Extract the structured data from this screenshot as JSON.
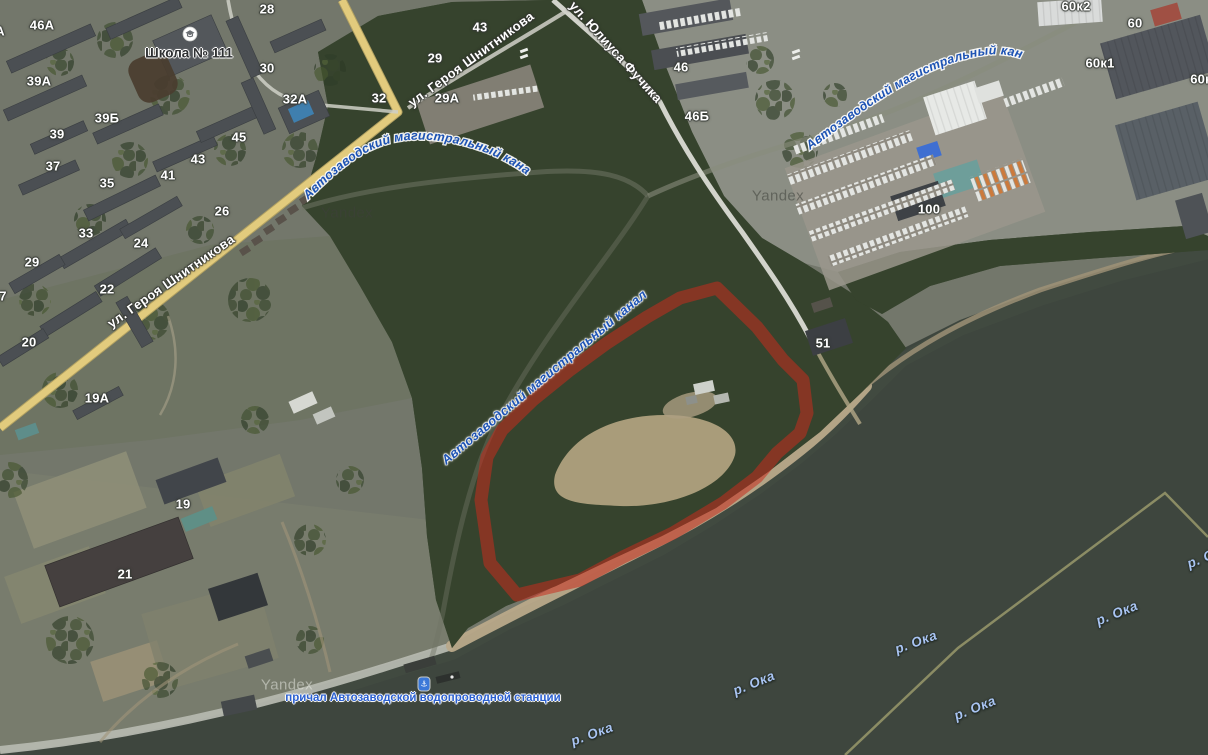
{
  "map": {
    "provider_watermark": "Yandex",
    "canal_label": "Автозаводский магистральный канал",
    "river_label": "р. Ока",
    "poi": {
      "school": {
        "label": "Школа № 111",
        "icon": "school-icon"
      },
      "pier": {
        "label": "причал Автозаводской водопроводной станции",
        "icon": "anchor-icon"
      }
    },
    "street_labels": [
      {
        "text": "ул. Героя Шнитникова",
        "x": 171,
        "y": 281,
        "rotate": -35
      },
      {
        "text": "ул. Героя Шнитникова",
        "x": 471,
        "y": 59,
        "rotate": -36
      },
      {
        "text": "ул. Юлиуса Фучика",
        "x": 616,
        "y": 52,
        "rotate": 48
      }
    ],
    "canal_label_placements": [
      {
        "placement": "forest-diagonal",
        "x": 544,
        "y": 377,
        "rotate": -40
      },
      {
        "placement": "curved-top-center"
      },
      {
        "placement": "curved-top-right"
      }
    ],
    "river_labels": [
      {
        "x": 592,
        "y": 734,
        "rotate": -20
      },
      {
        "x": 754,
        "y": 683,
        "rotate": -22
      },
      {
        "x": 916,
        "y": 642,
        "rotate": -20
      },
      {
        "x": 975,
        "y": 708,
        "rotate": -22
      },
      {
        "x": 1117,
        "y": 613,
        "rotate": -22
      },
      {
        "x": 1208,
        "y": 556,
        "rotate": -22
      }
    ],
    "house_numbers": [
      {
        "text": "А",
        "x": 0,
        "y": 31
      },
      {
        "text": "46А",
        "x": 42,
        "y": 25
      },
      {
        "text": "28",
        "x": 267,
        "y": 9
      },
      {
        "text": "30",
        "x": 267,
        "y": 68
      },
      {
        "text": "39А",
        "x": 39,
        "y": 81
      },
      {
        "text": "32А",
        "x": 295,
        "y": 99
      },
      {
        "text": "32",
        "x": 379,
        "y": 98
      },
      {
        "text": "39Б",
        "x": 107,
        "y": 118
      },
      {
        "text": "39",
        "x": 57,
        "y": 134
      },
      {
        "text": "45",
        "x": 239,
        "y": 137
      },
      {
        "text": "43",
        "x": 198,
        "y": 159
      },
      {
        "text": "37",
        "x": 53,
        "y": 166
      },
      {
        "text": "41",
        "x": 168,
        "y": 175
      },
      {
        "text": "35",
        "x": 107,
        "y": 183
      },
      {
        "text": "33",
        "x": 86,
        "y": 233
      },
      {
        "text": "26",
        "x": 222,
        "y": 211
      },
      {
        "text": "24",
        "x": 141,
        "y": 243
      },
      {
        "text": "29",
        "x": 32,
        "y": 262
      },
      {
        "text": "22",
        "x": 107,
        "y": 289
      },
      {
        "text": "7",
        "x": 3,
        "y": 296
      },
      {
        "text": "20",
        "x": 29,
        "y": 342
      },
      {
        "text": "19А",
        "x": 97,
        "y": 398
      },
      {
        "text": "19",
        "x": 183,
        "y": 504
      },
      {
        "text": "21",
        "x": 125,
        "y": 574
      },
      {
        "text": "29",
        "x": 435,
        "y": 58
      },
      {
        "text": "29А",
        "x": 447,
        "y": 98
      },
      {
        "text": "43",
        "x": 480,
        "y": 27
      },
      {
        "text": "46",
        "x": 681,
        "y": 67
      },
      {
        "text": "46Б",
        "x": 697,
        "y": 116
      },
      {
        "text": "51",
        "x": 823,
        "y": 343
      },
      {
        "text": "100",
        "x": 929,
        "y": 209
      },
      {
        "text": "60к2",
        "x": 1076,
        "y": 6
      },
      {
        "text": "60",
        "x": 1135,
        "y": 23
      },
      {
        "text": "60к1",
        "x": 1100,
        "y": 63
      },
      {
        "text": "60к",
        "x": 1201,
        "y": 79
      }
    ],
    "watermarks": [
      {
        "x": 347,
        "y": 213,
        "tone": "dark"
      },
      {
        "x": 778,
        "y": 196,
        "tone": "dark"
      },
      {
        "x": 287,
        "y": 685,
        "tone": "light"
      }
    ],
    "colors": {
      "highlight": "rgba(198,44,30,0.55)",
      "water": "#3e463e",
      "forest": "#36442d",
      "road_yellow": "#e2cb7d",
      "canal_label_blue": "#1d53b4",
      "river_label_blue": "#a9c4f2",
      "boundary_line": "#8f9066"
    }
  }
}
